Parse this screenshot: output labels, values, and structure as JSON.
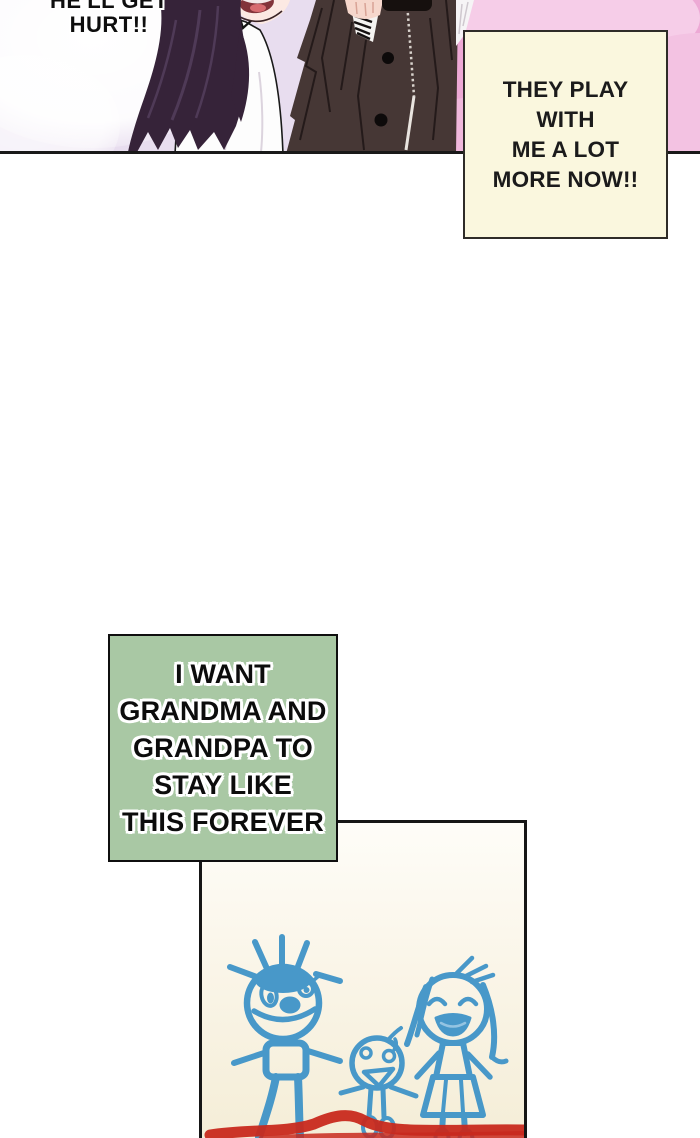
{
  "comic": {
    "shout_bubble": {
      "lines": [
        "HE'LL GET",
        "HURT!!"
      ]
    },
    "yellow_caption": {
      "lines": [
        "THEY PLAY",
        "WITH",
        "ME A LOT",
        "MORE NOW!!"
      ],
      "bg_color": "#faf7de",
      "border_color": "#2e2c28"
    },
    "green_caption": {
      "lines": [
        "I WANT",
        "GRANDMA AND",
        "GRANDPA TO",
        "STAY LIKE",
        "THIS FOREVER"
      ],
      "bg_color": "#a9c8a4",
      "border_color": "#0f0f0f"
    },
    "top_panel": {
      "background_left_color": "#e8ddef",
      "background_right_color": "#eda9d5",
      "hair_color": "#362339",
      "coat_color": "#463735",
      "border_color": "#191919"
    },
    "drawing_panel": {
      "figures": [
        "grandpa",
        "child",
        "grandma"
      ],
      "crayon_blue": "#3f94c8",
      "crayon_red": "#c8291e",
      "paper_color": "#f7f1dd",
      "border_color": "#161616"
    }
  }
}
